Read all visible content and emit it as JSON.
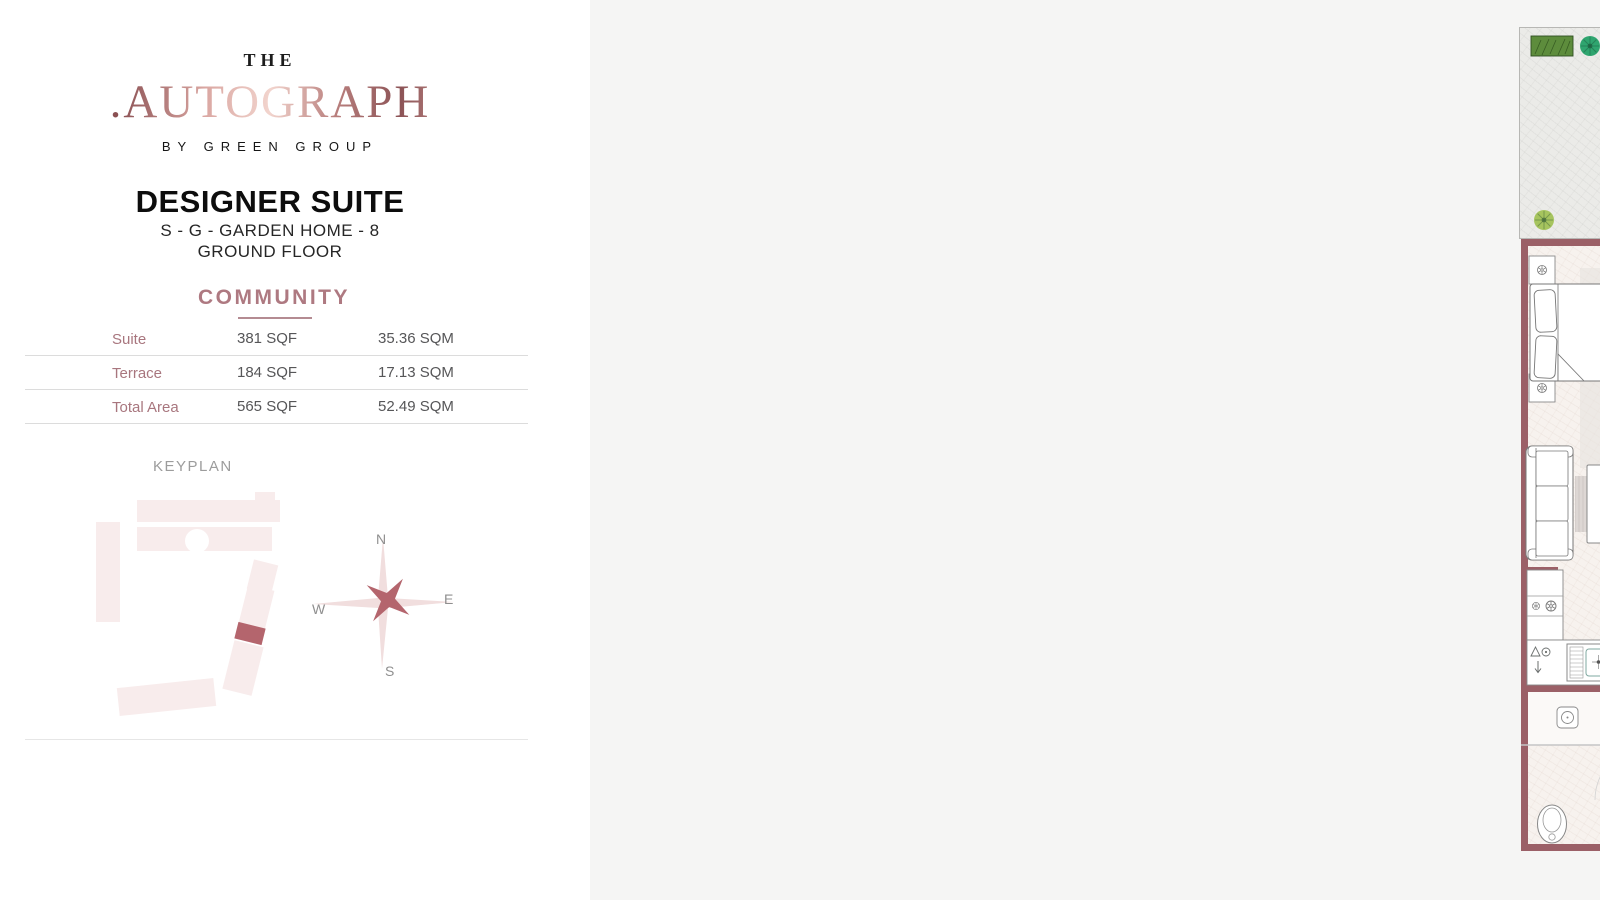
{
  "brand": {
    "kicker": "THE",
    "dot": ".",
    "name": "AUTOGRAPH",
    "tagline": "BY GREEN GROUP"
  },
  "unit": {
    "title": "DESIGNER SUITE",
    "subtitle": "S - G - GARDEN HOME - 8",
    "floor": "GROUND FLOOR"
  },
  "community": {
    "heading": "COMMUNITY",
    "rows": [
      {
        "label": "Suite",
        "sqf": "381 SQF",
        "sqm": "35.36 SQM"
      },
      {
        "label": "Terrace",
        "sqf": "184 SQF",
        "sqm": "17.13 SQM"
      },
      {
        "label": "Total Area",
        "sqf": "565 SQF",
        "sqm": "52.49 SQM"
      }
    ]
  },
  "keyplan": {
    "heading": "KEYPLAN"
  },
  "compass": {
    "n": "N",
    "e": "E",
    "s": "S",
    "w": "W"
  },
  "plan": {
    "badge": "A1",
    "dims": {
      "living": "457 x 364",
      "kitchen": "177 x 364"
    },
    "labels": {
      "fridge": "FR/MW",
      "bar": "BB",
      "laundry": "LAU"
    }
  },
  "watermark": {
    "dot": ".",
    "letter": "A"
  },
  "colors": {
    "wall": "#9b6067",
    "accent": "#b4656d",
    "rose": "#ae7981",
    "badge_text": "#8d565c"
  }
}
